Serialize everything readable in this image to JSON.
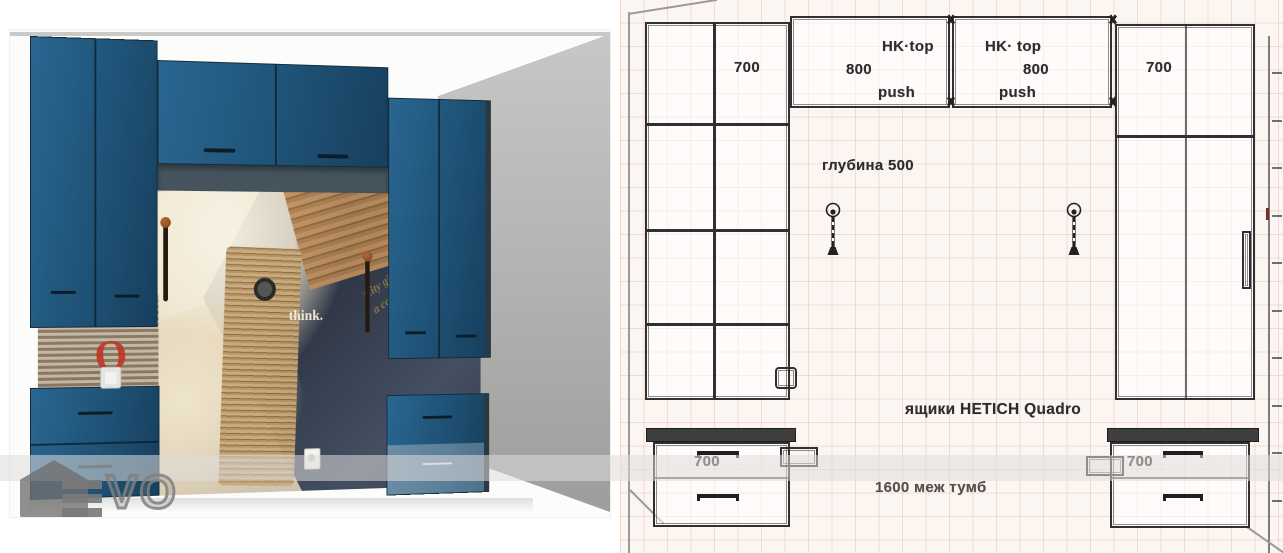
{
  "watermark": {
    "brand_text": "EVO",
    "vo_part": "VO"
  },
  "render": {
    "mural": {
      "headline_line1": "City gives New Year",
      "headline_line2": "a colorful welcome",
      "think_text": "think.",
      "red_letter": "O"
    },
    "colors": {
      "cabinet_blue": "#1f5377",
      "cabinet_blue_light": "#5b7f99",
      "soffit_gray": "#46545d",
      "side_wall_gray": "#b0b0ae",
      "handle_knob_copper": "#8a4a22"
    }
  },
  "drawing": {
    "labels": {
      "left_column_width": "700",
      "top_left_cabinet": {
        "hinge": "HK·top",
        "width": "800",
        "open": "push"
      },
      "top_right_cabinet": {
        "hinge": "HK· top",
        "width": "800",
        "open": "push"
      },
      "right_column_width": "700",
      "depth_note": "глубина 500",
      "drawer_system_note": "ящики HETICH Quadro",
      "between_note": "1600 меж тумб",
      "base_left_width": "700",
      "base_right_width": "700"
    },
    "colors": {
      "grid_line": "#e7c0b6",
      "wire_line": "#303030",
      "label_ink": "#2d2d2d"
    }
  }
}
